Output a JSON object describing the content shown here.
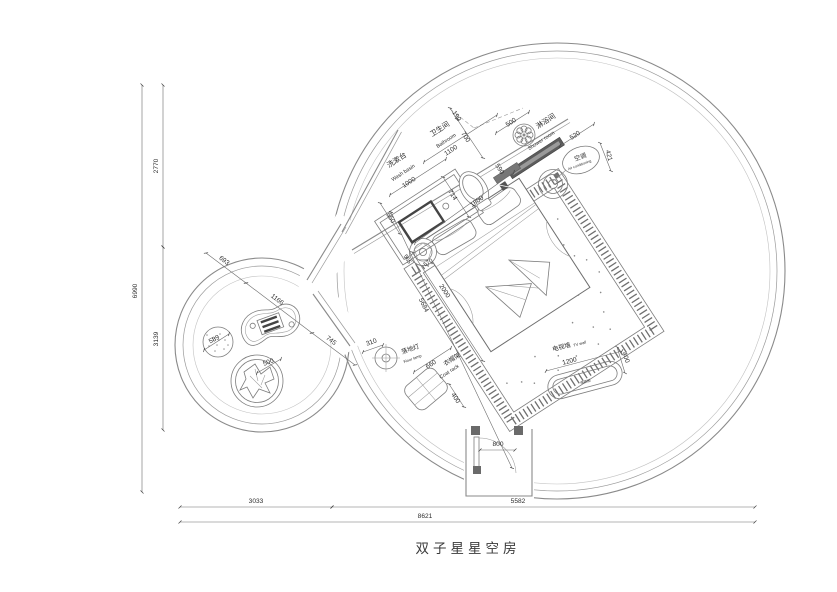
{
  "title": "双子星星空房",
  "dimensions": {
    "left_total": "6990",
    "left_top": "2770",
    "left_mid": "3139",
    "bottom_left": "3033",
    "bottom_right": "5582",
    "bottom_total": "8621"
  },
  "rooms": {
    "washbasin": {
      "cn": "洗漱台",
      "en": "Wash basin",
      "width": "1000"
    },
    "bathroom": {
      "cn": "卫生间",
      "en": "Bathroom",
      "width": "1100"
    },
    "shower": {
      "cn": "淋浴间",
      "en": "Shower room"
    },
    "ac": {
      "cn": "空调",
      "en": "Air conditioning"
    },
    "floor_lamp": {
      "cn": "落地灯",
      "en": "Floor lamp"
    },
    "coat_rack": {
      "cn": "衣帽架",
      "en": "Coat rack"
    },
    "tv_wall": {
      "cn": "电视墙",
      "en": "TV wall",
      "cabinet": "电视柜"
    }
  },
  "dims": {
    "d190": "190",
    "d700": "700",
    "d500": "500",
    "d590": "590",
    "d520": "520",
    "d421": "421",
    "d714": "714",
    "d1800": "1800",
    "d550": "550",
    "d565": "565",
    "d570": "570",
    "d2000": "2000",
    "d5684": "5684",
    "d310": "310",
    "d660": "660",
    "d400_rack": "400",
    "d1200": "1200",
    "d400_tv": "400",
    "d800": "800",
    "d693": "693",
    "d1166": "1166",
    "d745": "745",
    "d589": "589",
    "d500_chair": "500"
  }
}
